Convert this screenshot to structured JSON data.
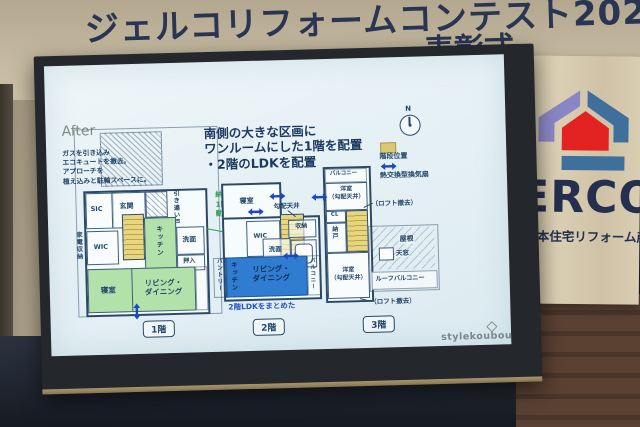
{
  "scene": {
    "banner": {
      "title": "ジェルコリフォームコンテスト2023",
      "subtitle_partial": "表彰式"
    },
    "jerco_banner": {
      "wordmark": "JERCO",
      "org": "人 日本住宅リフォーム産"
    }
  },
  "slide": {
    "after": "After",
    "heading": "南側の大きな区画に\nワンルームにした1階を配置\n・2階のLDKを配置",
    "compass_n": "N",
    "legend": {
      "stairs": "階段位置",
      "fan": "熱交換型換気扇"
    },
    "watermark": "stylekoubou",
    "floor1": {
      "tag": "1階",
      "note_gas": "ガスを引き込み\nエコキュートを撤去。\nアプローチを\n植え込みと駐輪スペースに。",
      "note_sliding": "引き違い戸",
      "note_seismic": "納戸扱いだった\n1階を耐震壁を移\n動し居室化。",
      "note_window": "窓を新設",
      "rooms": {
        "sic": "SIC",
        "entrance": "玄関",
        "wic": "WIC",
        "kitchen": "キッチン",
        "wash": "洗面",
        "oshiire": "押入",
        "bedroom": "寝室",
        "living": "リビング・\nダイニング",
        "appliance": "家電収納"
      }
    },
    "floor2": {
      "tag": "2階",
      "note_ldk": "2階LDKをまとめた",
      "note_ceiling": "勾配天井",
      "rooms": {
        "bedroom": "寝室",
        "wic": "WIC",
        "storage": "収納",
        "wash": "洗面",
        "kitchen": "キッチン",
        "living": "リビング・\nダイニング",
        "balcony": "バルコニー",
        "pantry": "パントリー"
      }
    },
    "floor3": {
      "tag": "3階",
      "note_loft_top": "（ロフト撤去）",
      "note_loft_bottom": "（ロフト撤去）",
      "rooms": {
        "balcony": "バルコニー",
        "western_top": "洋室\n（勾配天井）",
        "cl": "CL",
        "nando": "納戸",
        "roof": "屋根",
        "skylight": "天窓",
        "roof_balcony": "ルーフバルコニー",
        "western_bottom": "洋室\n（勾配天井）"
      }
    }
  }
}
